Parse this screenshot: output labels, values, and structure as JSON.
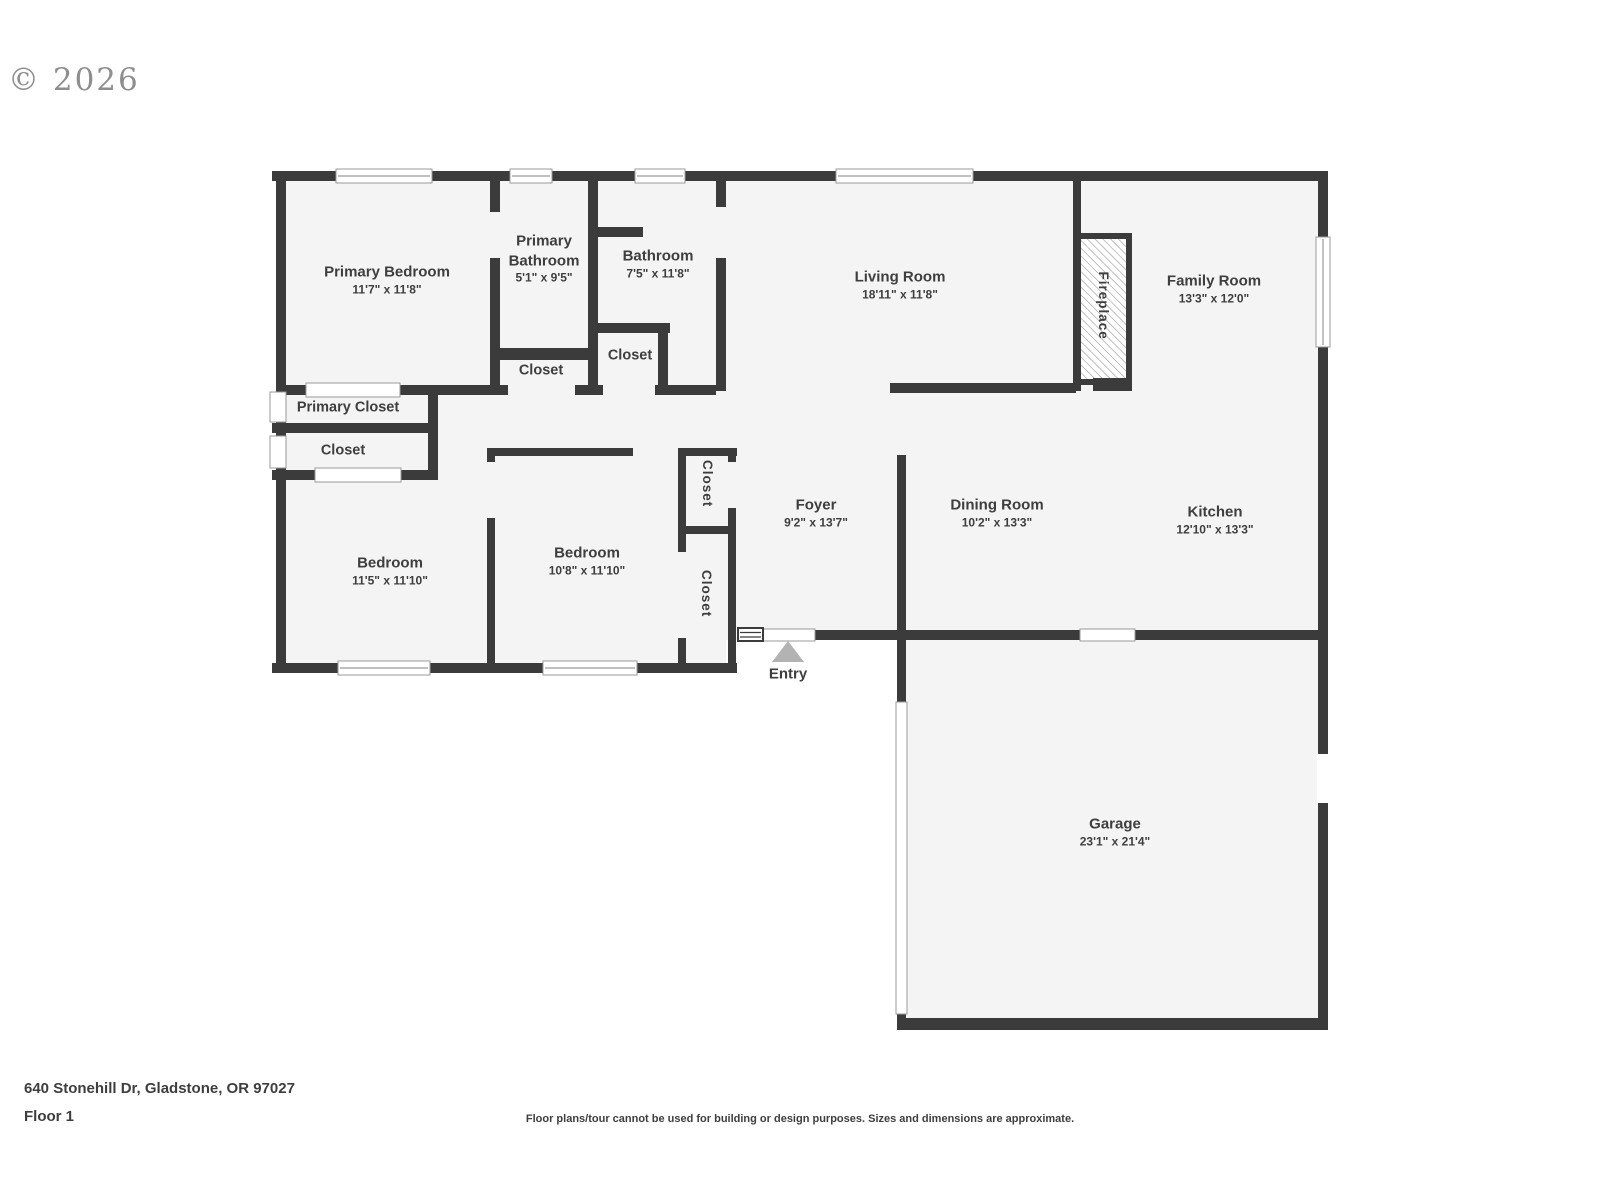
{
  "watermark": "© 2026",
  "rooms": {
    "primary_bedroom": {
      "name": "Primary Bedroom",
      "dims": "11'7\" x 11'8\""
    },
    "primary_bathroom": {
      "name": "Primary Bathroom",
      "dims": "5'1\" x 9'5\""
    },
    "bathroom": {
      "name": "Bathroom",
      "dims": "7'5\" x 11'8\""
    },
    "living_room": {
      "name": "Living Room",
      "dims": "18'11\" x 11'8\""
    },
    "family_room": {
      "name": "Family Room",
      "dims": "13'3\" x 12'0\""
    },
    "fireplace": {
      "name": "Fireplace"
    },
    "primary_closet": {
      "name": "Primary Closet"
    },
    "closet_hall": {
      "name": "Closet"
    },
    "closet_linen": {
      "name": "Closet"
    },
    "closet_bath": {
      "name": "Closet"
    },
    "bedroom_left": {
      "name": "Bedroom",
      "dims": "11'5\" x 11'10\""
    },
    "bedroom_middle": {
      "name": "Bedroom",
      "dims": "10'8\" x 11'10\""
    },
    "closet_upper": {
      "name": "Closet"
    },
    "closet_lower": {
      "name": "Closet"
    },
    "foyer": {
      "name": "Foyer",
      "dims": "9'2\" x 13'7\""
    },
    "dining_room": {
      "name": "Dining Room",
      "dims": "10'2\" x 13'3\""
    },
    "kitchen": {
      "name": "Kitchen",
      "dims": "12'10\" x 13'3\""
    },
    "garage": {
      "name": "Garage",
      "dims": "23'1\" x 21'4\""
    },
    "entry": {
      "name": "Entry"
    }
  },
  "footer": {
    "address": "640 Stonehill Dr, Gladstone, OR 97027",
    "floor": "Floor 1",
    "disclaimer": "Floor plans/tour cannot be used for building or design purposes. Sizes and dimensions are approximate."
  },
  "colors": {
    "wall": "#3b3b3c",
    "floor": "#f4f4f4",
    "window_outline": "#9a9a9a",
    "entry_arrow": "#b3b3b3",
    "text": "#3e3e40",
    "watermark": "#8e8e8e"
  }
}
